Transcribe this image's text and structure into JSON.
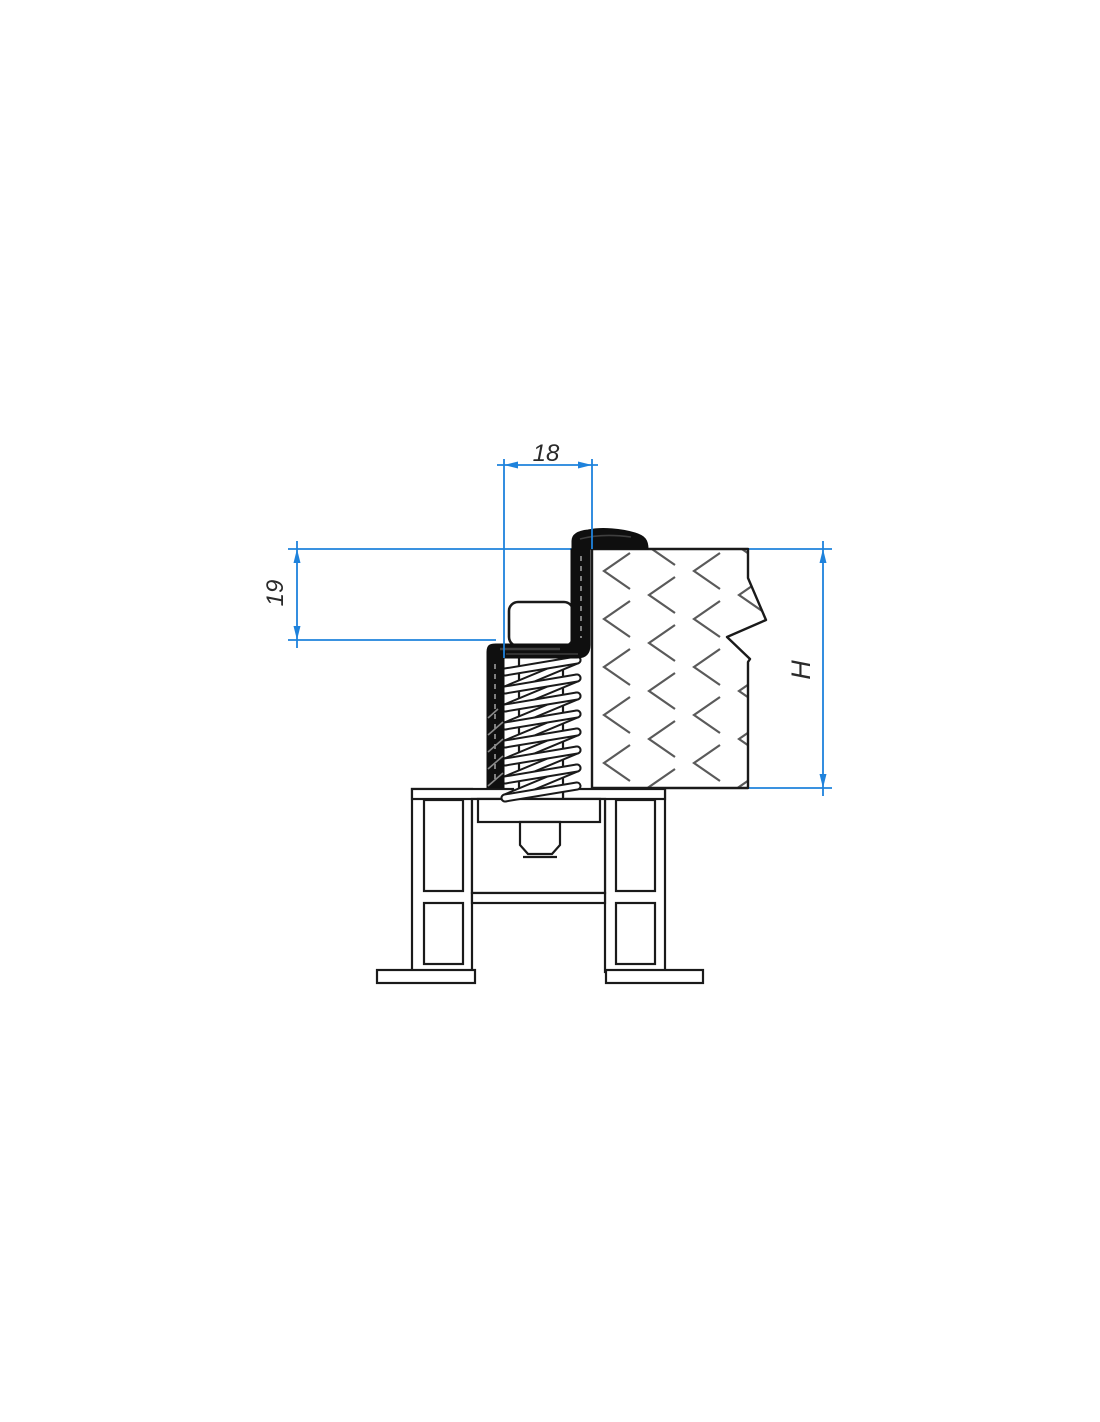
{
  "drawing": {
    "type": "technical-cross-section",
    "dimension_labels": {
      "top_width": "18",
      "left_height": "19",
      "right_height": "H"
    },
    "colors": {
      "dimension_lines": "#1e82dc",
      "outlines": "#1a1a1a",
      "hatch": "#5a5a5a",
      "seal_fill": "#0f0f0f",
      "background": "#ffffff"
    }
  }
}
